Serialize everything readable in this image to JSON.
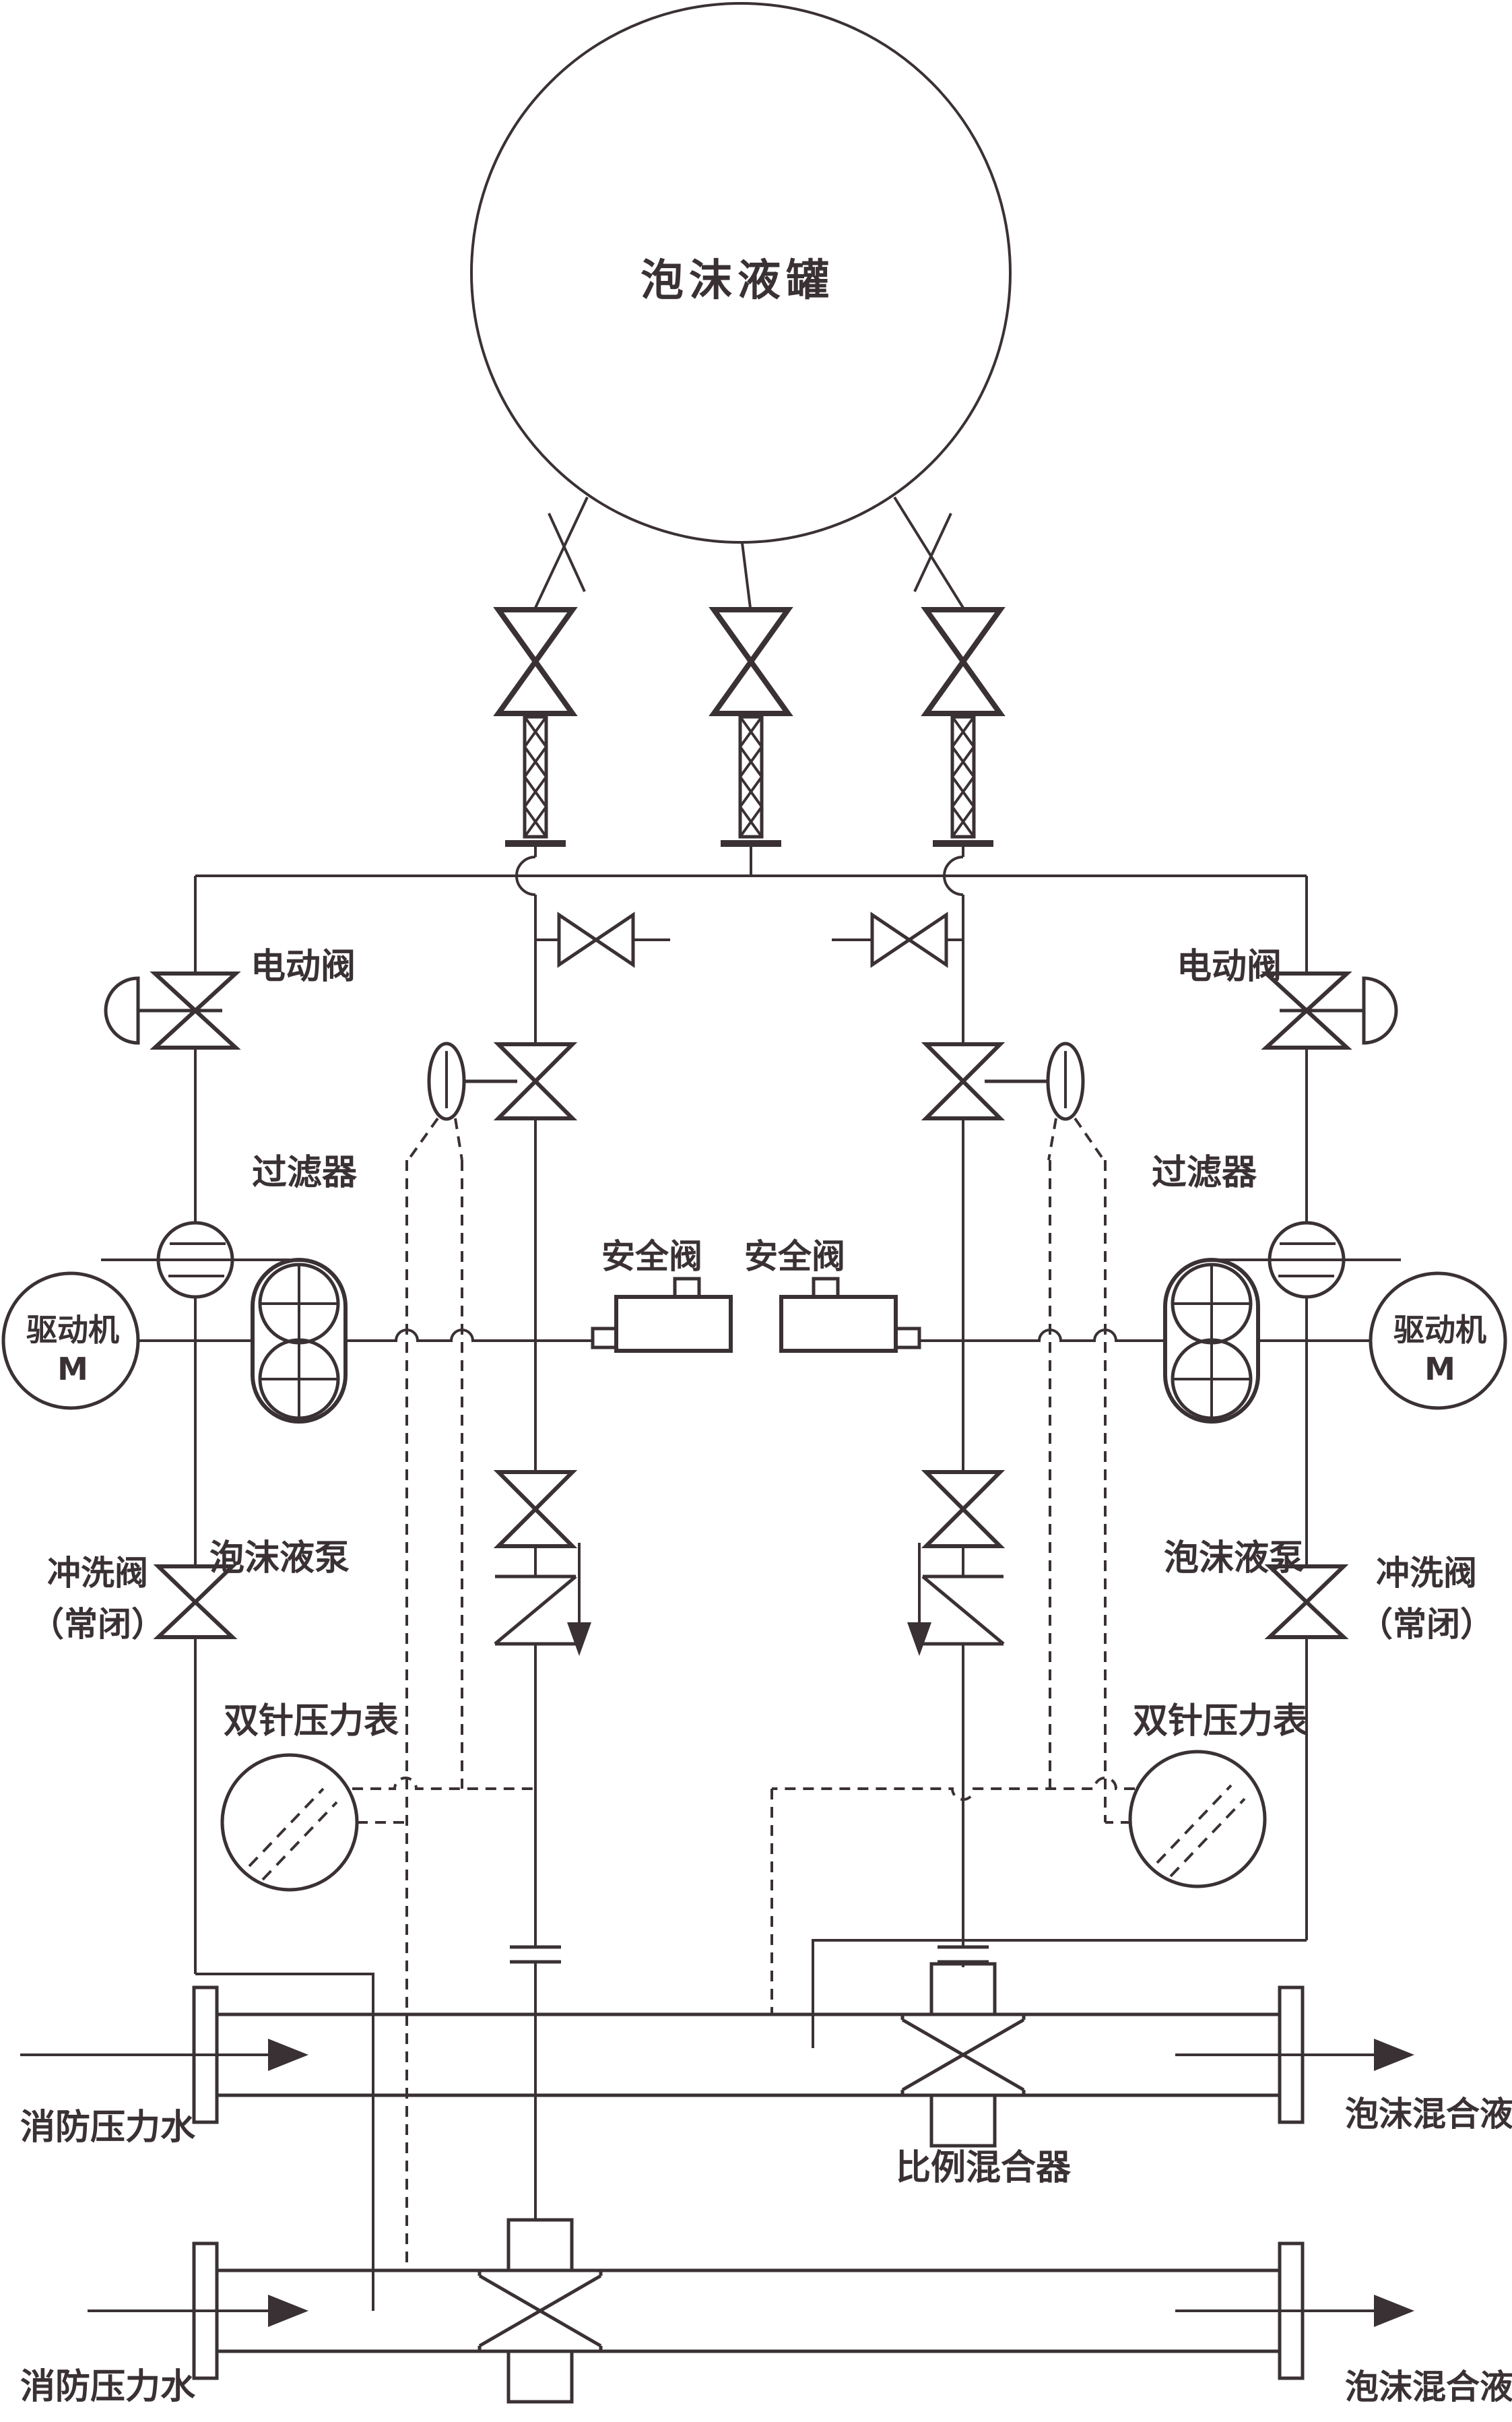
{
  "colors": {
    "line": "#3a3134",
    "bg": "#ffffff"
  },
  "labels": {
    "tank": "泡沫液罐",
    "electric_valve": "电动阀",
    "filter": "过滤器",
    "motor_line1": "驱动机",
    "motor_line2": "M",
    "foam_pump": "泡沫液泵",
    "flush_valve_line1": "冲洗阀",
    "flush_valve_line2": "（常闭）",
    "safety_valve": "安全阀",
    "gauge": "双针压力表",
    "mixer": "比例混合器",
    "inlet_water": "消防压力水",
    "outlet_mix": "泡沫混合液"
  }
}
